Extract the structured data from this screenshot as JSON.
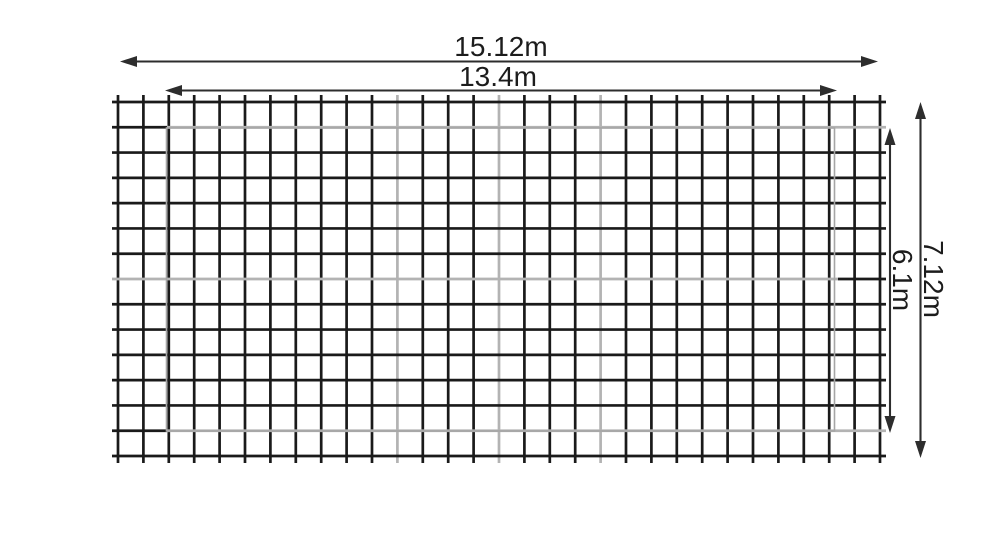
{
  "diagram": {
    "title": "wire-mesh-panel-dimension-drawing",
    "dimensions": {
      "outer_width": {
        "label": "15.12m"
      },
      "inner_width": {
        "label": "13.4m"
      },
      "outer_height": {
        "label": "7.12m"
      },
      "inner_height": {
        "label": "6.1m"
      }
    },
    "mesh": {
      "columns": 30,
      "rows": 14
    },
    "colors": {
      "wire": "#1a1a1a",
      "faded_wire": "#b3b3b3",
      "reference_outline": "#a6a6a6",
      "dimension": "#2d2d2d",
      "text": "#1c1c1c",
      "background": "#ffffff"
    }
  }
}
